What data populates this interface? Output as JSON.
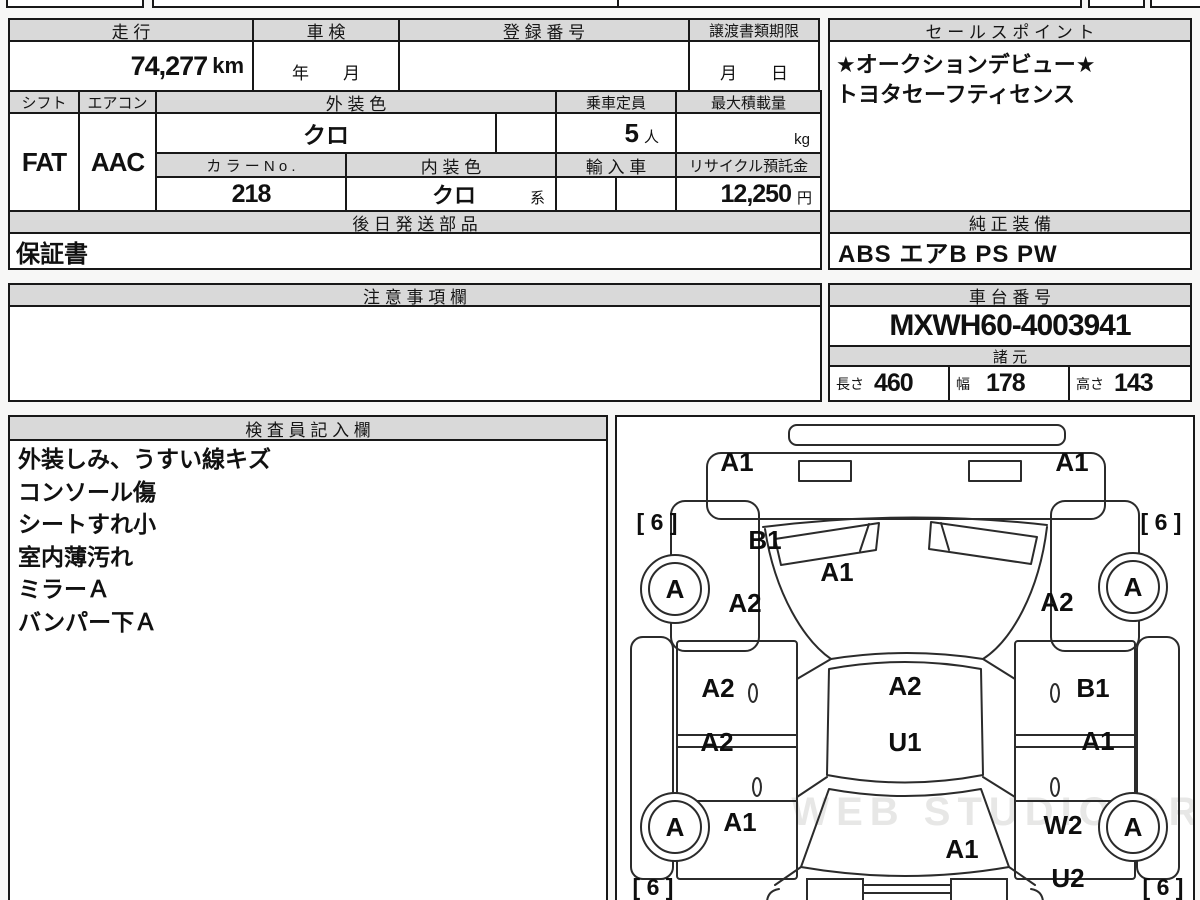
{
  "top_table": {
    "mileage_label": "走 行",
    "mileage_value": "74,277",
    "mileage_unit": "km",
    "shaken_label": "車 検",
    "shaken_value": "年　　月",
    "reg_label": "登 録 番 号",
    "transfer_label": "譲渡書類期限",
    "transfer_value": "月　　日",
    "shift_label": "シフト",
    "shift_value": "FAT",
    "aircon_label": "エアコン",
    "aircon_value": "AAC",
    "ext_color_label": "外 装 色",
    "ext_color_value": "クロ",
    "capacity_label": "乗車定員",
    "capacity_value": "5",
    "capacity_unit": "人",
    "max_load_label": "最大積載量",
    "max_load_unit": "kg",
    "color_no_label": "カ ラ ー N o .",
    "color_no_value": "218",
    "int_color_label": "内 装 色",
    "int_color_value": "クロ",
    "int_color_suffix": "系",
    "import_label": "輸 入 車",
    "recycle_label": "リサイクル預託金",
    "recycle_value": "12,250",
    "recycle_unit": "円"
  },
  "sales_point": {
    "label": "セ ー ル ス ポ イ ン ト",
    "lines": [
      "★オークションデビュー★",
      "トヨタセーフティセンス"
    ]
  },
  "later_parts": {
    "label": "後 日 発 送 部 品",
    "value": "保証書"
  },
  "genuine_equipment": {
    "label": "純 正 装 備",
    "value": "ABS エアB PS PW"
  },
  "notes": {
    "label": "注 意 事 項 欄",
    "value": ""
  },
  "chassis": {
    "label": "車 台 番 号",
    "value": "MXWH60-4003941"
  },
  "specs": {
    "label": "諸 元",
    "length_label": "長さ",
    "length_value": "460",
    "width_label": "幅",
    "width_value": "178",
    "height_label": "高さ",
    "height_value": "143"
  },
  "inspector": {
    "label": "検 査 員 記 入 欄",
    "lines": [
      "外装しみ、うすい線キズ",
      "コンソール傷",
      "シートすれ小",
      "室内薄汚れ",
      "ミラーＡ",
      "バンパー下Ａ"
    ]
  },
  "diagram": {
    "watermark": "WEB STUDIO PRO",
    "tire_mark": "[ 6 ]",
    "wheel_a": "A",
    "codes": [
      {
        "part": "front-bumper-left",
        "text": "A1"
      },
      {
        "part": "front-bumper-right",
        "text": "A1"
      },
      {
        "part": "front-fender-left",
        "text": "B1"
      },
      {
        "part": "hood",
        "text": "A1"
      },
      {
        "part": "front-left",
        "text": "A2"
      },
      {
        "part": "front-right",
        "text": "A2"
      },
      {
        "part": "front-door-left",
        "text": "A2"
      },
      {
        "part": "roof",
        "text": "A2"
      },
      {
        "part": "front-door-right",
        "text": "B1"
      },
      {
        "part": "rear-door-left",
        "text": "A2"
      },
      {
        "part": "floor",
        "text": "U1"
      },
      {
        "part": "rear-door-right",
        "text": "A1"
      },
      {
        "part": "rear-fender-left",
        "text": "A1"
      },
      {
        "part": "rear-fender-right",
        "text": "W2"
      },
      {
        "part": "rear-glass",
        "text": "A1"
      },
      {
        "part": "rear-right-lower",
        "text": "U2"
      }
    ]
  }
}
